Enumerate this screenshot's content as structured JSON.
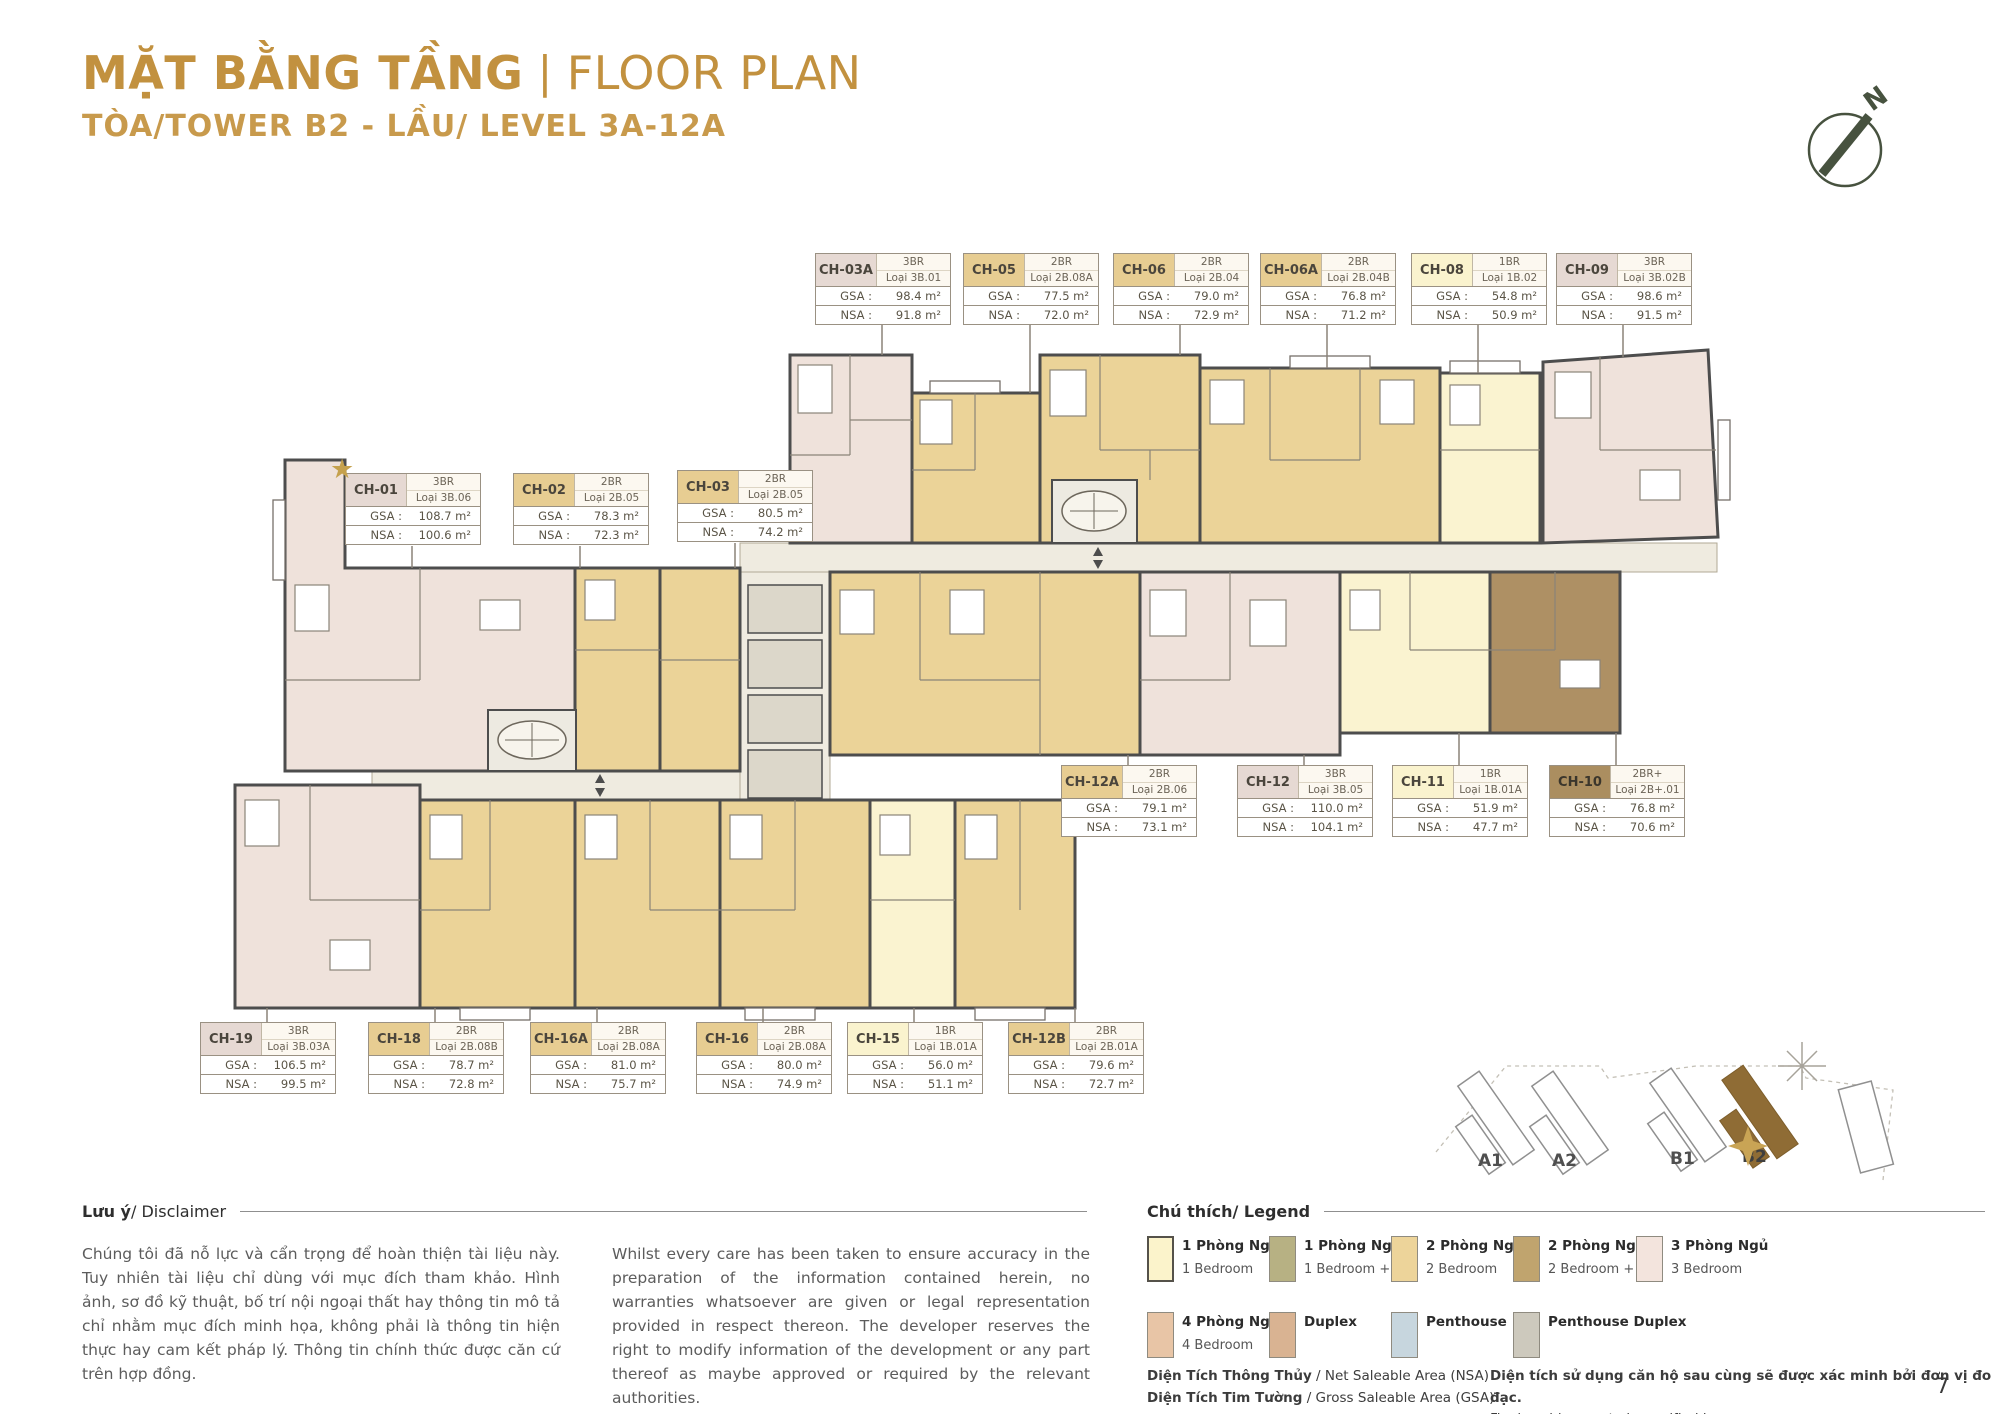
{
  "page": {
    "title_vn": "MẶT BẰNG TẦNG",
    "title_sep": "|",
    "title_en": "FLOOR PLAN",
    "subtitle": "TÒA/TOWER B2 - LẦU/ LEVEL 3A-12A",
    "page_number": "7",
    "compass_n": "N"
  },
  "area_labels": {
    "gsa": "GSA :",
    "nsa": "NSA :"
  },
  "units": [
    {
      "id": "CH-01",
      "br": "3BR",
      "type": "Loại 3B.06",
      "gsa": "108.7 m²",
      "nsa": "100.6 m²",
      "star": true
    },
    {
      "id": "CH-02",
      "br": "2BR",
      "type": "Loại 2B.05",
      "gsa": "78.3 m²",
      "nsa": "72.3 m²"
    },
    {
      "id": "CH-03",
      "br": "2BR",
      "type": "Loại 2B.05",
      "gsa": "80.5 m²",
      "nsa": "74.2 m²"
    },
    {
      "id": "CH-03A",
      "br": "3BR",
      "type": "Loại 3B.01",
      "gsa": "98.4 m²",
      "nsa": "91.8 m²"
    },
    {
      "id": "CH-05",
      "br": "2BR",
      "type": "Loại 2B.08A",
      "gsa": "77.5 m²",
      "nsa": "72.0 m²"
    },
    {
      "id": "CH-06",
      "br": "2BR",
      "type": "Loại 2B.04",
      "gsa": "79.0 m²",
      "nsa": "72.9 m²"
    },
    {
      "id": "CH-06A",
      "br": "2BR",
      "type": "Loại 2B.04B",
      "gsa": "76.8 m²",
      "nsa": "71.2 m²"
    },
    {
      "id": "CH-08",
      "br": "1BR",
      "type": "Loại 1B.02",
      "gsa": "54.8 m²",
      "nsa": "50.9 m²"
    },
    {
      "id": "CH-09",
      "br": "3BR",
      "type": "Loại 3B.02B",
      "gsa": "98.6 m²",
      "nsa": "91.5 m²"
    },
    {
      "id": "CH-12A",
      "br": "2BR",
      "type": "Loại 2B.06",
      "gsa": "79.1 m²",
      "nsa": "73.1 m²"
    },
    {
      "id": "CH-12",
      "br": "3BR",
      "type": "Loại 3B.05",
      "gsa": "110.0 m²",
      "nsa": "104.1 m²"
    },
    {
      "id": "CH-11",
      "br": "1BR",
      "type": "Loại 1B.01A",
      "gsa": "51.9 m²",
      "nsa": "47.7 m²"
    },
    {
      "id": "CH-10",
      "br": "2BR+",
      "type": "Loại 2B+.01",
      "gsa": "76.8 m²",
      "nsa": "70.6 m²"
    },
    {
      "id": "CH-19",
      "br": "3BR",
      "type": "Loại 3B.03A",
      "gsa": "106.5 m²",
      "nsa": "99.5 m²"
    },
    {
      "id": "CH-18",
      "br": "2BR",
      "type": "Loại 2B.08B",
      "gsa": "78.7 m²",
      "nsa": "72.8 m²"
    },
    {
      "id": "CH-16A",
      "br": "2BR",
      "type": "Loại 2B.08A",
      "gsa": "81.0 m²",
      "nsa": "75.7 m²"
    },
    {
      "id": "CH-16",
      "br": "2BR",
      "type": "Loại 2B.08A",
      "gsa": "80.0 m²",
      "nsa": "74.9 m²"
    },
    {
      "id": "CH-15",
      "br": "1BR",
      "type": "Loại 1B.01A",
      "gsa": "56.0 m²",
      "nsa": "51.1 m²"
    },
    {
      "id": "CH-12B",
      "br": "2BR",
      "type": "Loại 2B.01A",
      "gsa": "79.6 m²",
      "nsa": "72.7 m²"
    }
  ],
  "disclaimer": {
    "heading_bold": "Lưu ý",
    "heading_rest": " / Disclaimer",
    "text_vn": "Chúng tôi đã nỗ lực và cẩn trọng để hoàn thiện tài liệu này. Tuy nhiên tài liệu chỉ dùng với mục đích tham khảo. Hình ảnh, sơ đồ kỹ thuật, bố trí nội ngoại thất hay thông tin mô tả chỉ nhằm mục đích minh họa, không phải là thông tin hiện thực hay cam kết pháp lý. Thông tin chính thức được căn cứ trên hợp đồng.",
    "text_en": "Whilst every care has been taken to ensure accuracy in the preparation of the information contained herein, no warranties whatsoever are given or legal representation provided in respect thereon. The developer reserves the right to modify information of the development or any part thereof as maybe approved or required by the relevant authorities."
  },
  "legend": {
    "heading_bold": "Chú thích",
    "heading_rest": " / Legend",
    "items": [
      {
        "vn": "1 Phòng Ngủ",
        "en": "1 Bedroom",
        "color": "#FBF3CB"
      },
      {
        "vn": "1 Phòng Ngủ +",
        "en": "1 Bedroom +",
        "color": "#B7B183"
      },
      {
        "vn": "2 Phòng Ngủ",
        "en": "2 Bedroom",
        "color": "#EDD49A"
      },
      {
        "vn": "2 Phòng Ngủ +",
        "en": "2 Bedroom +",
        "color": "#C0A46E"
      },
      {
        "vn": "3 Phòng Ngủ",
        "en": "3 Bedroom",
        "color": "#F3E4DD"
      },
      {
        "vn": "4 Phòng Ngủ",
        "en": "4 Bedroom",
        "color": "#E8C5A6"
      },
      {
        "vn": "Duplex",
        "en": "",
        "color": "#D9B392"
      },
      {
        "vn": "Penthouse",
        "en": "",
        "color": "#C7D6DE"
      },
      {
        "vn": "Penthouse Duplex",
        "en": "",
        "color": "#CDC9BD"
      }
    ],
    "notes": [
      {
        "bold": "Diện Tích Thông Thủy",
        "rest": " / Net Saleable Area (NSA)"
      },
      {
        "bold": "Diện Tích Tim Tường",
        "rest": " / Gross Saleable Area (GSA)"
      }
    ],
    "verify_vn": "Diện tích sử dụng căn hộ sau cùng sẽ được xác minh bởi đơn vị đo đạc.",
    "verify_en": "Final usable area to be verified by surveyor."
  },
  "minimap": {
    "towers": [
      "A1",
      "A2",
      "B1",
      "B2"
    ],
    "highlighted": "B2"
  },
  "colors": {
    "accent_gold": "#C2913F",
    "unit_pink": "#EFE2DB",
    "unit_gold": "#EBD398",
    "unit_yellow": "#FAF3D0",
    "unit_brown": "#AE9064",
    "corridor": "#EFEBE0",
    "header_pink": "#E6D9D3",
    "header_gold": "#E7CD92",
    "header_yellow": "#FAF3CE",
    "header_brown": "#AB8E60",
    "minimap_highlight": "#8F6C35"
  }
}
